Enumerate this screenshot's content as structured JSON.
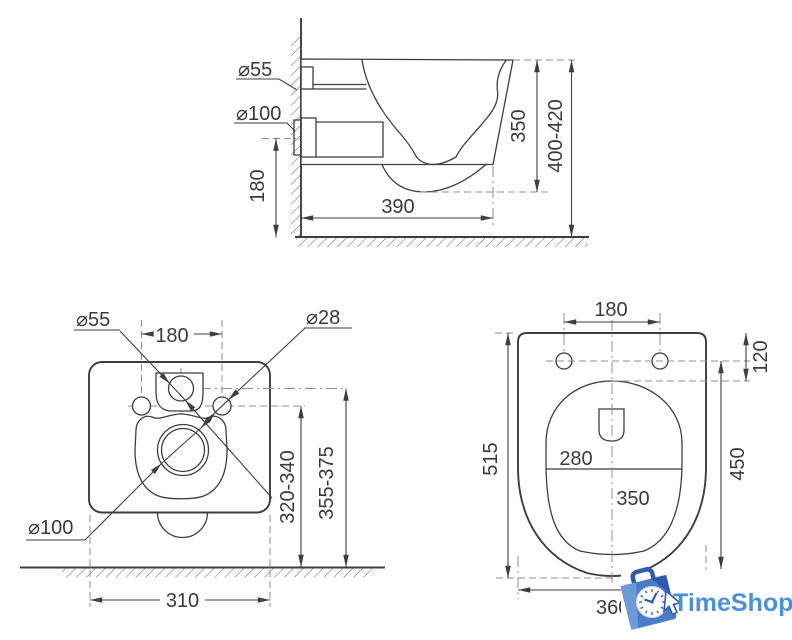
{
  "colors": {
    "background": "#ffffff",
    "line": "#3e3e3e",
    "dash_line": "#8f8f8f",
    "logo_text_blue": "#4a92d8",
    "logo_bag_blue": "#4a7cc7",
    "logo_bag_dark": "#2e5cab",
    "logo_bag_light": "#6d9ad8"
  },
  "side_view": {
    "inlet_diameter": "⌀55",
    "outlet_diameter": "⌀100",
    "outlet_height": "180",
    "depth": "390",
    "body_height": "350",
    "install_height": "400-420"
  },
  "rear_view": {
    "inlet_diameter": "⌀55",
    "bolt_spacing": "180",
    "bolt_diameter": "⌀28",
    "outlet_diameter": "⌀100",
    "bolt_height": "320-340",
    "inlet_height": "355-375",
    "width": "310"
  },
  "top_view": {
    "bolt_spacing": "180",
    "bolt_offset": "120",
    "length": "515",
    "inner_width": "280",
    "inner_length": "350",
    "bowl_length": "450",
    "width": "360"
  },
  "logo": {
    "brand": "TimeShop"
  }
}
